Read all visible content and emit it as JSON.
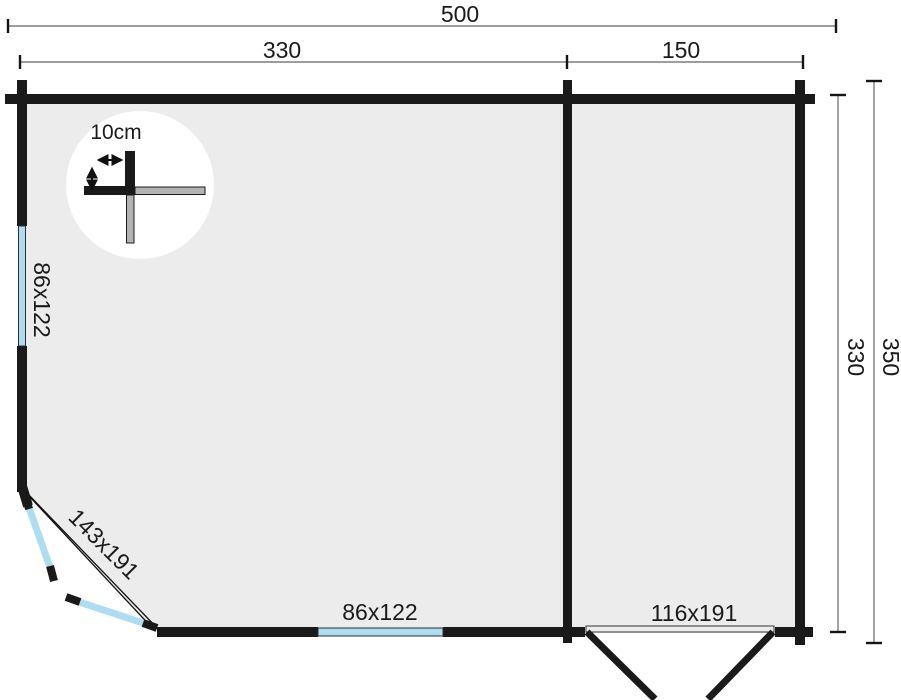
{
  "plan": {
    "type": "cabin-floor-plan",
    "dimensions": {
      "total_width": "500",
      "main_room_width": "330",
      "side_room_width": "150",
      "inner_depth": "330",
      "total_depth": "350"
    },
    "openings": {
      "left_window": "86x122",
      "bottom_window": "86x122",
      "corner_door": "143x191",
      "front_door": "116x191"
    },
    "detail": {
      "wall_thickness": "10cm"
    },
    "colors": {
      "wall": "#1a1a1a",
      "floor": "#ececec",
      "window": "#aedcf0",
      "dimline": "#7d7d7d",
      "detailgray": "#b3b3b3",
      "background": "#ffffff"
    }
  }
}
